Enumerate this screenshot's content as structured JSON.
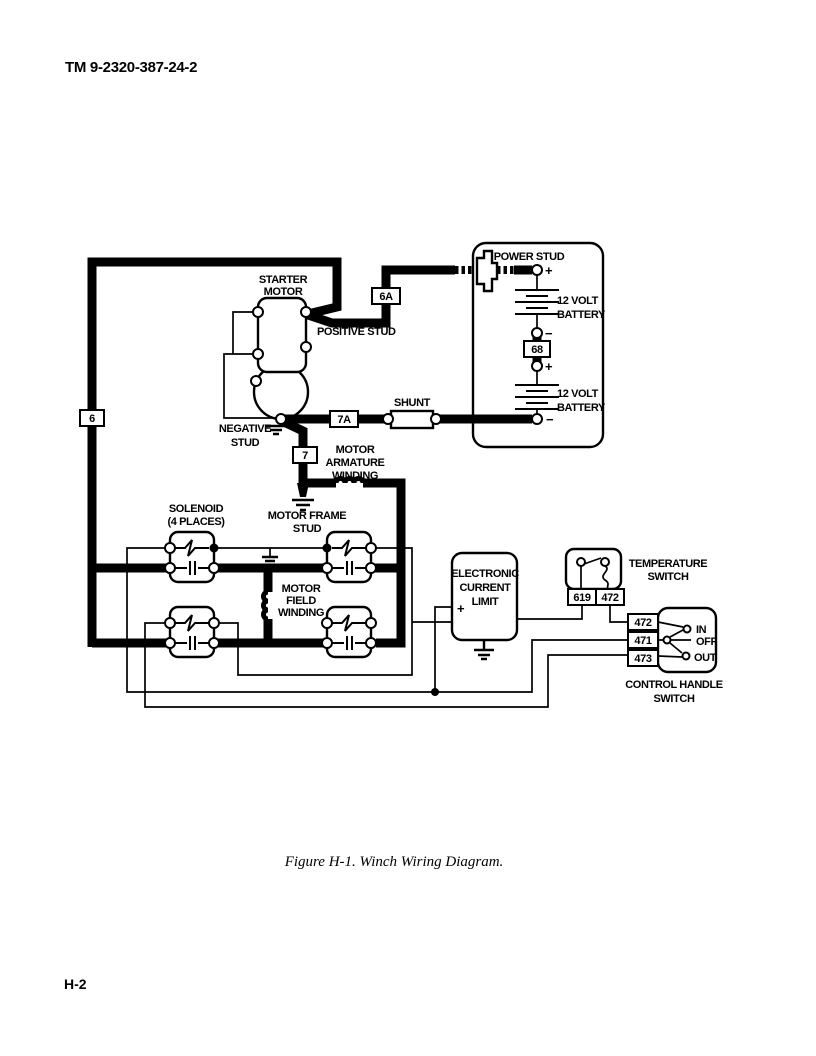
{
  "page": {
    "header": "TM 9-2320-387-24-2",
    "caption": "Figure H-1.  Winch Wiring Diagram.",
    "page_number": "H-2"
  },
  "labels": {
    "power_stud": "POWER STUD",
    "battery_top": [
      "12 VOLT",
      "BATTERY"
    ],
    "battery_bottom": [
      "12 VOLT",
      "BATTERY"
    ],
    "starter_motor": [
      "STARTER",
      "MOTOR"
    ],
    "positive_stud": "POSITIVE STUD",
    "negative_stud": [
      "NEGATIVE",
      "STUD"
    ],
    "shunt": "SHUNT",
    "motor_armature": [
      "MOTOR",
      "ARMATURE",
      "WINDING"
    ],
    "motor_frame": [
      "MOTOR FRAME",
      "STUD"
    ],
    "solenoid": [
      "SOLENOID",
      "(4 PLACES)"
    ],
    "motor_field": [
      "MOTOR",
      "FIELD",
      "WINDING"
    ],
    "ecl": [
      "ELECTRONIC",
      "CURRENT",
      "LIMIT"
    ],
    "temperature_switch": [
      "TEMPERATURE",
      "SWITCH"
    ],
    "control_handle": [
      "CONTROL HANDLE",
      "SWITCH"
    ],
    "pos_in": "IN",
    "pos_off": "OFF",
    "pos_out": "OUT",
    "plus": "+",
    "minus": "−"
  },
  "wire_labels": {
    "w6": "6",
    "w6a": "6A",
    "w7": "7",
    "w7a": "7A",
    "w68": "68",
    "t619": "619",
    "t472": "472",
    "c472": "472",
    "c471": "471",
    "c473": "473"
  },
  "colors": {
    "ink": "#000000",
    "paper": "#ffffff"
  }
}
